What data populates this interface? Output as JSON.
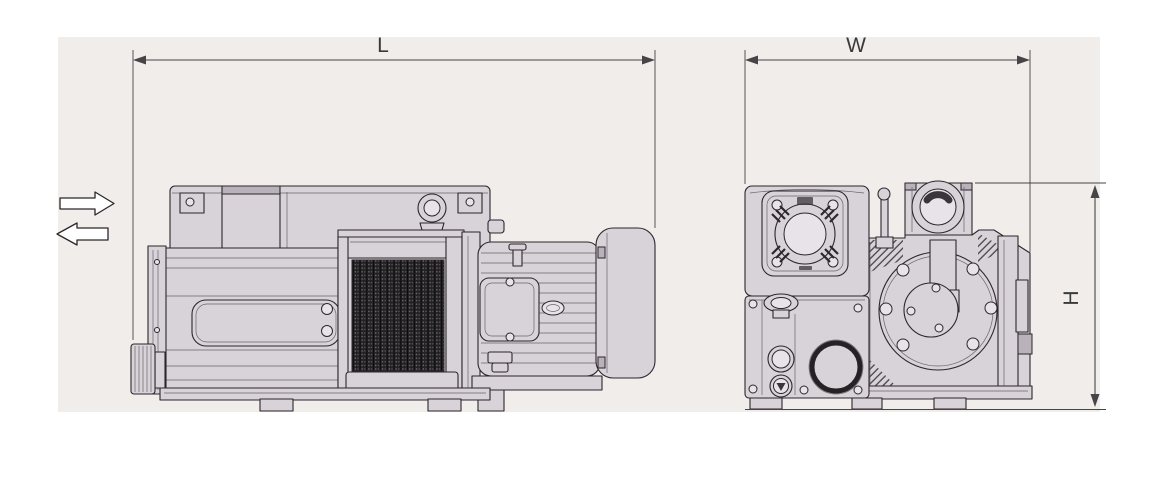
{
  "colors": {
    "page": "#ffffff",
    "panel": "#f1edeb",
    "line": "#2b272b",
    "line-soft": "#6a656a",
    "body": "#d8d2d9",
    "body-light": "#e7e3e8",
    "body-dark": "#b9b2bb",
    "grille-dark": "#242224",
    "dim-line": "#474447",
    "label": "#3a3a3a"
  },
  "dimensions": {
    "length_label": "L",
    "width_label": "W",
    "height_label": "H"
  }
}
